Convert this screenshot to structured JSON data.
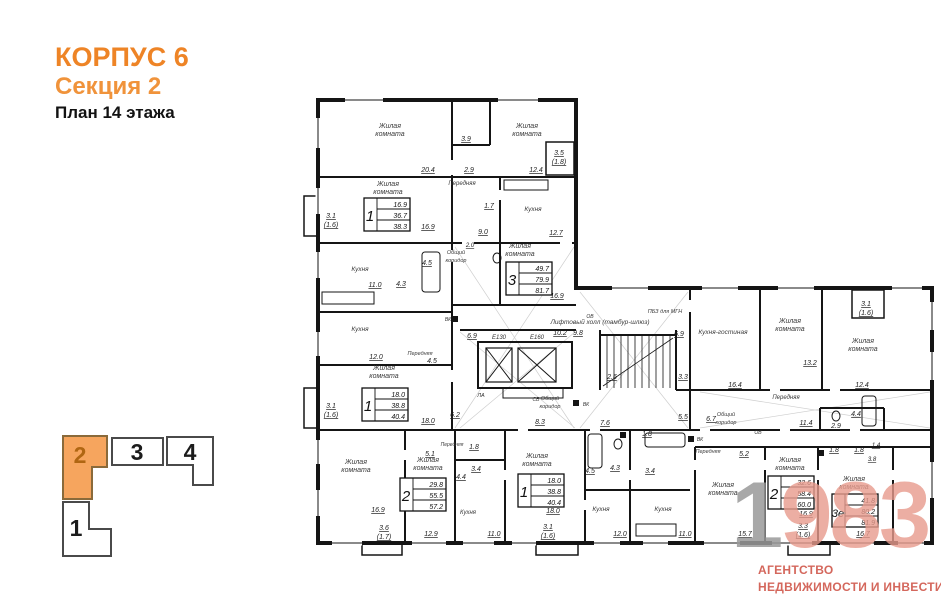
{
  "header": {
    "building": "КОРПУС 6",
    "section": "Секция 2",
    "floor_plan": "План 14 этажа"
  },
  "colors": {
    "accent_orange": "#ee8426",
    "minimap_fill": "#f6a55e",
    "watermark_gray": "#9a9a9a",
    "watermark_salmon": "#e89b8d",
    "agency_red": "#d4675c"
  },
  "minimap": {
    "sections": [
      {
        "label": "1",
        "active": false
      },
      {
        "label": "2",
        "active": true
      },
      {
        "label": "3",
        "active": false
      },
      {
        "label": "4",
        "active": false
      }
    ]
  },
  "watermark": {
    "number_gray": "1",
    "number_salmon": "983",
    "agency_line1": "АГЕНТСТВО",
    "agency_line2": "НЕДВИЖИМОСТИ И ИНВЕСТИЦИЙ"
  },
  "plan": {
    "room_labels": [
      {
        "lines": [
          "Жилая",
          "комната"
        ],
        "x": 390,
        "y": 128
      },
      {
        "lines": [
          "Жилая",
          "комната"
        ],
        "x": 527,
        "y": 128
      },
      {
        "lines": [
          "Жилая",
          "комната"
        ],
        "x": 388,
        "y": 186
      },
      {
        "t": "Передняя",
        "x": 462,
        "y": 185,
        "s": 6
      },
      {
        "t": "Кухня",
        "x": 533,
        "y": 211,
        "s": 6.5
      },
      {
        "t": "Кухня",
        "x": 360,
        "y": 271,
        "s": 6.5
      },
      {
        "lines": [
          "Общий",
          "коридор"
        ],
        "x": 456,
        "y": 254,
        "s": 5.5
      },
      {
        "lines": [
          "Жилая",
          "комната"
        ],
        "x": 520,
        "y": 248
      },
      {
        "t": "Лифтовый холл (тамбур-шлюз)",
        "x": 600,
        "y": 324,
        "s": 6.5
      },
      {
        "t": "Кухня",
        "x": 360,
        "y": 331,
        "s": 6.5
      },
      {
        "t": "Передняя",
        "x": 420,
        "y": 355,
        "s": 5.5
      },
      {
        "lines": [
          "Жилая",
          "комната"
        ],
        "x": 384,
        "y": 370
      },
      {
        "lines": [
          "Общий",
          "коридор"
        ],
        "x": 550,
        "y": 400,
        "s": 5.5
      },
      {
        "lines": [
          "Жилая",
          "комната"
        ],
        "x": 356,
        "y": 464
      },
      {
        "lines": [
          "Жилая",
          "комната"
        ],
        "x": 428,
        "y": 462
      },
      {
        "t": "Кухня",
        "x": 468,
        "y": 514,
        "s": 6
      },
      {
        "t": "Передняя",
        "x": 452,
        "y": 446,
        "s": 5
      },
      {
        "lines": [
          "Жилая",
          "комната"
        ],
        "x": 537,
        "y": 458
      },
      {
        "t": "Кухня",
        "x": 601,
        "y": 511,
        "s": 6.5
      },
      {
        "t": "Кухня",
        "x": 663,
        "y": 511,
        "s": 6.5
      },
      {
        "t": "Передняя",
        "x": 708,
        "y": 453,
        "s": 5.5
      },
      {
        "lines": [
          "Жилая",
          "комната"
        ],
        "x": 723,
        "y": 487
      },
      {
        "lines": [
          "Жилая",
          "комната"
        ],
        "x": 790,
        "y": 462
      },
      {
        "lines": [
          "Жилая",
          "комната"
        ],
        "x": 854,
        "y": 481
      },
      {
        "t": "Кухня-гостиная",
        "x": 723,
        "y": 334,
        "s": 6.5
      },
      {
        "lines": [
          "Жилая",
          "комната"
        ],
        "x": 790,
        "y": 323
      },
      {
        "lines": [
          "Жилая",
          "комната"
        ],
        "x": 863,
        "y": 343
      },
      {
        "t": "Передняя",
        "x": 786,
        "y": 399,
        "s": 6
      },
      {
        "t": "ПБЗ для МГН",
        "x": 665,
        "y": 313,
        "s": 5.5
      },
      {
        "lines": [
          "Общий",
          "коридор"
        ],
        "x": 726,
        "y": 416,
        "s": 5.5
      }
    ],
    "dims": [
      {
        "t": "20.4",
        "x": 428,
        "y": 172
      },
      {
        "t": "3.9",
        "x": 466,
        "y": 141
      },
      {
        "t": "12.4",
        "x": 536,
        "y": 172
      },
      {
        "t": "3.5",
        "x": 559,
        "y": 155
      },
      {
        "t": "(1.8)",
        "x": 559,
        "y": 164
      },
      {
        "t": "16.9",
        "x": 428,
        "y": 229
      },
      {
        "t": "2.9",
        "x": 469,
        "y": 172
      },
      {
        "t": "1.7",
        "x": 489,
        "y": 208
      },
      {
        "t": "12.7",
        "x": 556,
        "y": 235
      },
      {
        "t": "11.0",
        "x": 375,
        "y": 287
      },
      {
        "t": "4.3",
        "x": 401,
        "y": 286
      },
      {
        "t": "4.5",
        "x": 427,
        "y": 265
      },
      {
        "t": "9.0",
        "x": 483,
        "y": 234
      },
      {
        "t": "2.0",
        "x": 470,
        "y": 247,
        "s": 6
      },
      {
        "t": "16.9",
        "x": 557,
        "y": 298
      },
      {
        "t": "3.1",
        "x": 331,
        "y": 218
      },
      {
        "t": "(1.6)",
        "x": 331,
        "y": 227
      },
      {
        "t": "12.0",
        "x": 376,
        "y": 359
      },
      {
        "t": "4.5",
        "x": 432,
        "y": 363
      },
      {
        "t": "18.0",
        "x": 428,
        "y": 423
      },
      {
        "t": "6.2",
        "x": 455,
        "y": 417
      },
      {
        "t": "3.1",
        "x": 331,
        "y": 408
      },
      {
        "t": "(1.6)",
        "x": 331,
        "y": 417
      },
      {
        "t": "16.9",
        "x": 378,
        "y": 512
      },
      {
        "t": "3.6",
        "x": 384,
        "y": 530
      },
      {
        "t": "(1.7)",
        "x": 384,
        "y": 539
      },
      {
        "t": "5.1",
        "x": 430,
        "y": 456
      },
      {
        "t": "12.9",
        "x": 431,
        "y": 536
      },
      {
        "t": "1.8",
        "x": 474,
        "y": 449
      },
      {
        "t": "3.4",
        "x": 476,
        "y": 471
      },
      {
        "t": "4.4",
        "x": 461,
        "y": 479
      },
      {
        "t": "11.0",
        "x": 494,
        "y": 536
      },
      {
        "t": "18.0",
        "x": 553,
        "y": 513
      },
      {
        "t": "3.1",
        "x": 548,
        "y": 529
      },
      {
        "t": "(1.6)",
        "x": 548,
        "y": 538
      },
      {
        "t": "8.3",
        "x": 540,
        "y": 424
      },
      {
        "t": "7.6",
        "x": 605,
        "y": 425
      },
      {
        "t": "1.8",
        "x": 647,
        "y": 436
      },
      {
        "t": "4.5",
        "x": 590,
        "y": 473
      },
      {
        "t": "4.3",
        "x": 615,
        "y": 470
      },
      {
        "t": "3.4",
        "x": 650,
        "y": 473
      },
      {
        "t": "12.0",
        "x": 620,
        "y": 536
      },
      {
        "t": "11.0",
        "x": 685,
        "y": 536
      },
      {
        "t": "5.2",
        "x": 744,
        "y": 456
      },
      {
        "t": "15.7",
        "x": 745,
        "y": 536
      },
      {
        "t": "6.7",
        "x": 711,
        "y": 421
      },
      {
        "t": "6.9",
        "x": 679,
        "y": 336
      },
      {
        "t": "3.3",
        "x": 683,
        "y": 379
      },
      {
        "t": "2.6",
        "x": 612,
        "y": 379
      },
      {
        "t": "16.4",
        "x": 735,
        "y": 387
      },
      {
        "t": "5.5",
        "x": 683,
        "y": 419
      },
      {
        "t": "13.2",
        "x": 810,
        "y": 365
      },
      {
        "t": "12.4",
        "x": 862,
        "y": 387
      },
      {
        "t": "3.1",
        "x": 866,
        "y": 306
      },
      {
        "t": "(1.6)",
        "x": 866,
        "y": 315
      },
      {
        "t": "11.4",
        "x": 806,
        "y": 425
      },
      {
        "t": "2.9",
        "x": 836,
        "y": 428
      },
      {
        "t": "4.4",
        "x": 856,
        "y": 416
      },
      {
        "t": "1.8",
        "x": 834,
        "y": 452
      },
      {
        "t": "1.8",
        "x": 859,
        "y": 452
      },
      {
        "t": "1.4",
        "x": 876,
        "y": 447,
        "s": 6
      },
      {
        "t": "3.8",
        "x": 872,
        "y": 461,
        "s": 6
      },
      {
        "t": "16.9",
        "x": 806,
        "y": 516
      },
      {
        "t": "3.3",
        "x": 803,
        "y": 528
      },
      {
        "t": "(1.6)",
        "x": 803,
        "y": 537
      },
      {
        "t": "16.7",
        "x": 863,
        "y": 536
      },
      {
        "t": "10.2",
        "x": 560,
        "y": 335
      },
      {
        "t": "9.8",
        "x": 578,
        "y": 335
      },
      {
        "t": "6.9",
        "x": 472,
        "y": 338
      }
    ],
    "tech_labels": [
      {
        "t": "Е130",
        "x": 499,
        "y": 339,
        "s": 6
      },
      {
        "t": "Е160",
        "x": 537,
        "y": 339,
        "s": 6
      },
      {
        "t": "ЛА",
        "x": 481,
        "y": 397,
        "s": 5.5
      },
      {
        "t": "ВК",
        "x": 448,
        "y": 321,
        "s": 5
      },
      {
        "t": "ОВ",
        "x": 590,
        "y": 318,
        "s": 5
      },
      {
        "t": "СВ",
        "x": 536,
        "y": 401,
        "s": 5
      },
      {
        "t": "ВК",
        "x": 586,
        "y": 406,
        "s": 5
      },
      {
        "t": "ВК",
        "x": 700,
        "y": 441,
        "s": 5
      },
      {
        "t": "ОВ",
        "x": 758,
        "y": 434,
        "s": 5
      }
    ],
    "apartments": [
      {
        "num": "1",
        "values": [
          "16.9",
          "36.7",
          "38.3"
        ],
        "x": 364,
        "y": 198
      },
      {
        "num": "3",
        "values": [
          "49.7",
          "79.9",
          "81.7"
        ],
        "x": 506,
        "y": 262
      },
      {
        "num": "1",
        "values": [
          "18.0",
          "38.8",
          "40.4"
        ],
        "x": 362,
        "y": 388
      },
      {
        "num": "2",
        "values": [
          "29.8",
          "55.5",
          "57.2"
        ],
        "x": 400,
        "y": 478
      },
      {
        "num": "1",
        "values": [
          "18.0",
          "38.8",
          "40.4"
        ],
        "x": 518,
        "y": 474
      },
      {
        "num": "2",
        "values": [
          "32.6",
          "58.4",
          "60.0"
        ],
        "x": 768,
        "y": 476
      },
      {
        "num": "3е",
        "values": [
          "41.8",
          "80.2",
          "81.9"
        ],
        "x": 832,
        "y": 494
      }
    ]
  }
}
